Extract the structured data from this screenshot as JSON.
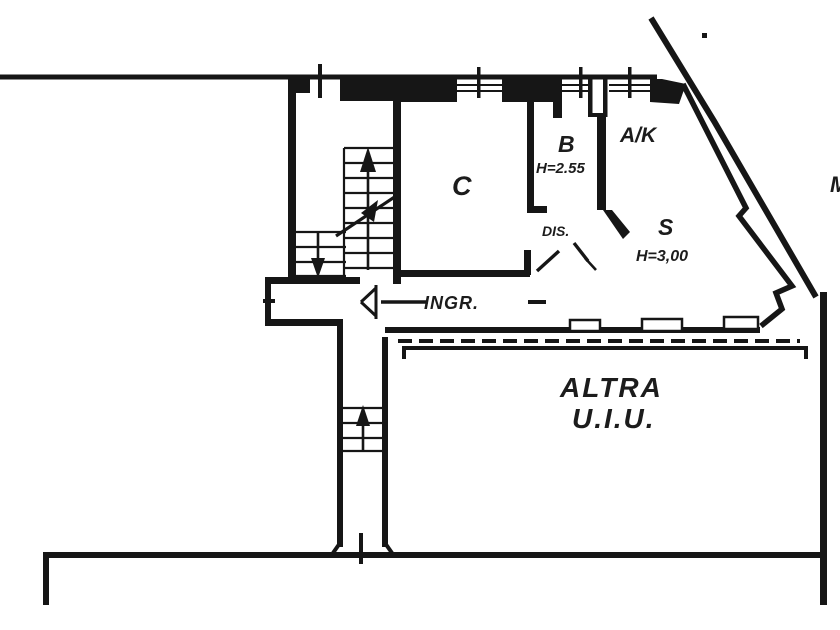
{
  "document": {
    "kind": "cadastral floor plan drawing",
    "background": "#ffffff"
  },
  "colors": {
    "ink": "#161616",
    "ink_soft": "#2b2b2b"
  },
  "labels": {
    "room_c": "C",
    "room_b": "B",
    "room_b_height": "H=2.55",
    "room_ak": "A/K",
    "room_s": "S",
    "room_s_height": "H=3,00",
    "hall_dis": "DIS.",
    "hall_ingr": "INGR.",
    "other_unit_line1": "ALTRA",
    "other_unit_line2": "U.I.U.",
    "edge_letter": "M"
  }
}
